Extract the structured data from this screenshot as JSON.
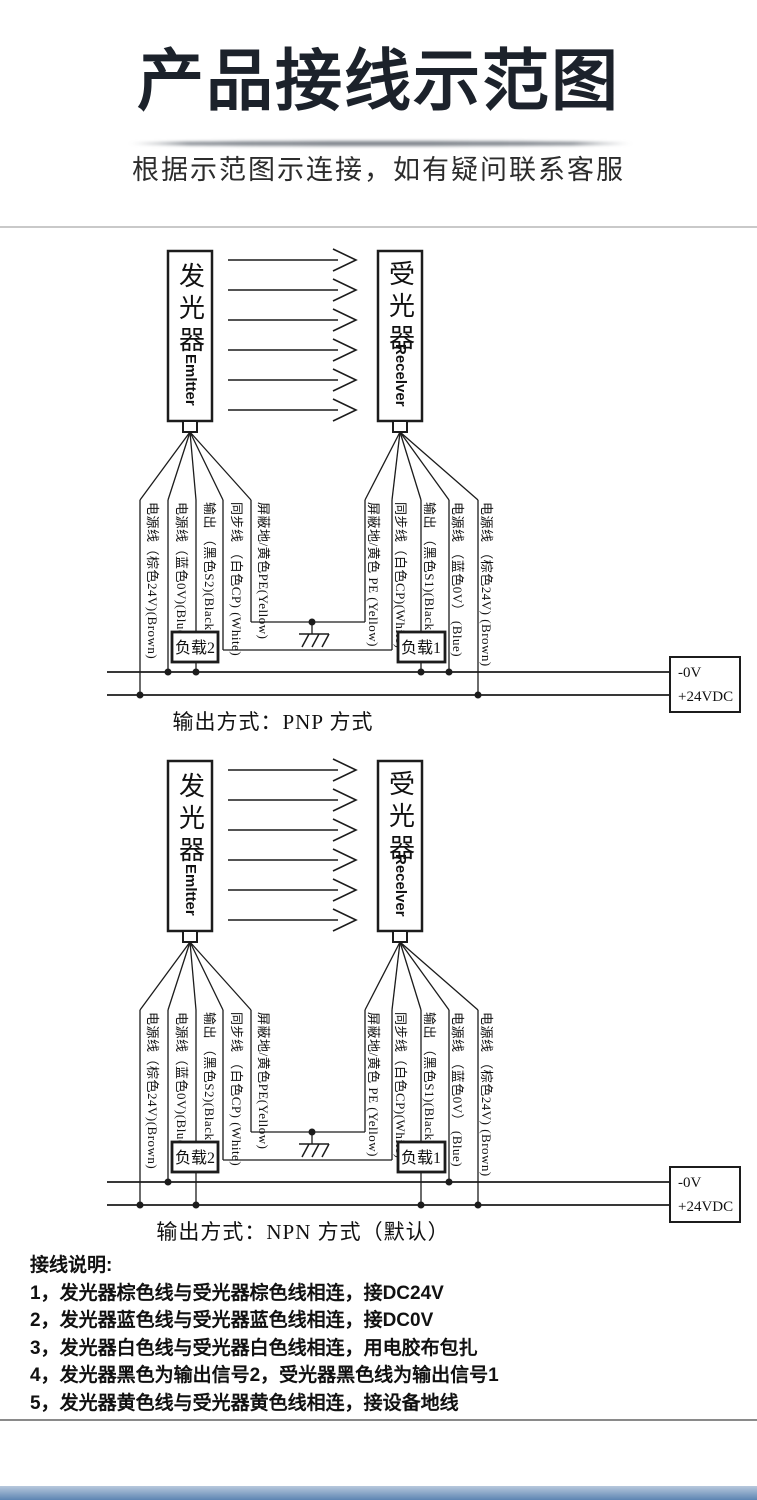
{
  "header": {
    "title": "产品接线示范图",
    "subtitle": "根据示范图示连接，如有疑问联系客服"
  },
  "device": {
    "emitter_cn": "发光器",
    "emitter_en": "Emltter",
    "receiver_cn": "受光器",
    "receiver_en": "Recelver"
  },
  "wires": {
    "left": [
      "电源线（棕色24V)(Brown)",
      "电源线（蓝色0V)(Blue)",
      "输出 （黑色S2)(Black)",
      "同步线 （白色CP) (White)",
      "屏蔽地/黄色PE(Yellow)"
    ],
    "right": [
      "屏蔽地/黄色 PE (Yellow)",
      "同步线（白色CP)(White)",
      "输出 （黑色S1)(Black)",
      "电源线 （蓝色0V） (Blue)",
      "电源线 （棕色24V) (Brown)"
    ]
  },
  "loads": {
    "left": "负载2",
    "right": "负载1"
  },
  "power": {
    "line1": "-0V",
    "line2": "+24VDC"
  },
  "pnp": {
    "caption": "输出方式：PNP 方式"
  },
  "npn": {
    "caption": "输出方式：NPN 方式（默认）"
  },
  "notes": {
    "heading": "接线说明:",
    "items": [
      "1，发光器棕色线与受光器棕色线相连，接DC24V",
      "2，发光器蓝色线与受光器蓝色线相连，接DC0V",
      "3，发光器白色线与受光器白色线相连，用电胶布包扎",
      "4，发光器黑色为输出信号2，受光器黑色线为输出信号1",
      "5，发光器黄色线与受光器黄色线相连，接设备地线"
    ]
  },
  "colors": {
    "ink": "#1c1c1c",
    "bottom_bar_top": "#b7c8dc",
    "bottom_bar_bottom": "#5d85b2"
  }
}
